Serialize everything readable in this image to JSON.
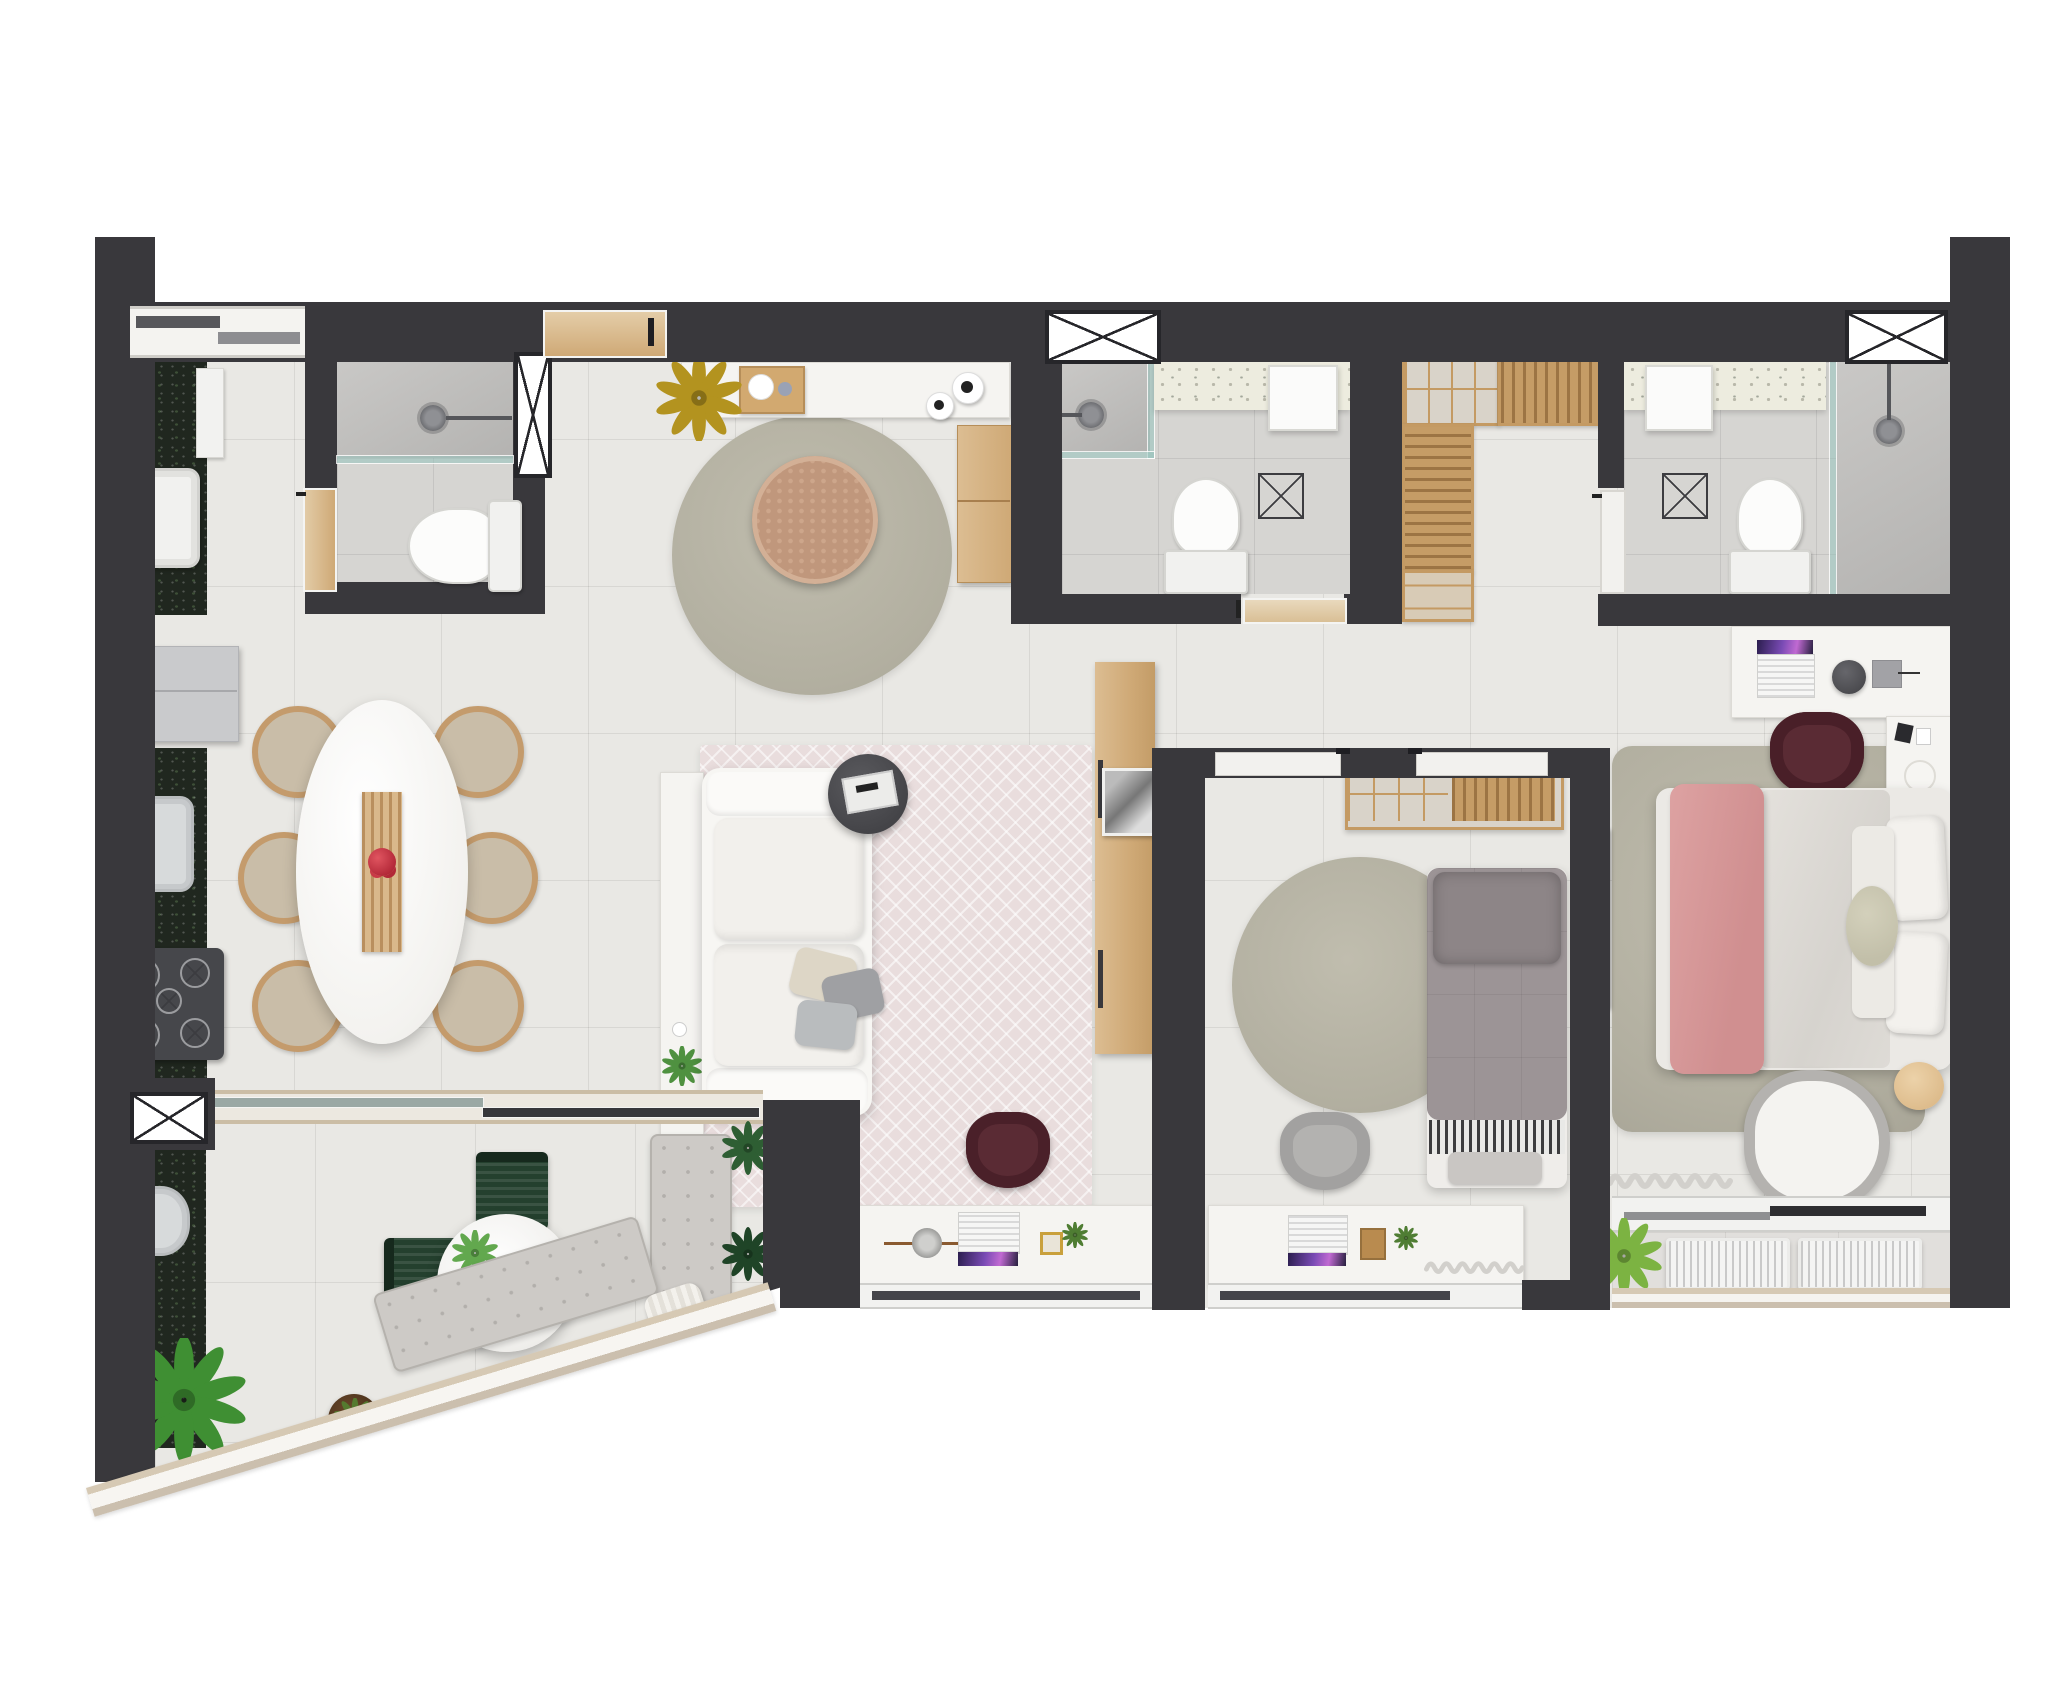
{
  "document": {
    "type": "apartment-floor-plan-rendering",
    "view": "top-down 3D render",
    "visible_text": "none"
  },
  "palette": {
    "wall": "#39383c",
    "floor": "#e9e8e4",
    "bathfloor": "#d6d5d2",
    "granite": "#20271f",
    "terrazzo": "#edecdf",
    "wood": "#d2a970",
    "wood_light": "#dcbd92",
    "rug_sage": "#b5b2a3",
    "rug_pink": "#e9dddd",
    "bed_pink": "#d89798",
    "duvet_gray": "#9c9496",
    "chair_burgundy": "#5a2b34",
    "chair_green": "#24402e",
    "furniture_white": "#f5f4f1"
  },
  "rooms": [
    {
      "name": "service-area",
      "furniture": [
        "granite-counter",
        "laundry-sink",
        "tall-cabinet",
        "sliding-service-door"
      ]
    },
    {
      "name": "service-bathroom",
      "furniture": [
        "shower-head",
        "glass-partition",
        "window",
        "toilet",
        "wooden-door"
      ]
    },
    {
      "name": "entry-hall",
      "furniture": [
        "entry-door",
        "sideboard",
        "wooden-tray-with-cups",
        "two-canisters",
        "yellow-plant",
        "round-rug",
        "rattan-pouf",
        "wooden-bench"
      ]
    },
    {
      "name": "bathroom-2",
      "furniture": [
        "window",
        "corner-shower",
        "glass-partition",
        "terrazzo-counter",
        "sink",
        "toilet",
        "floor-drain",
        "pocket-door"
      ]
    },
    {
      "name": "walk-in-closet",
      "furniture": [
        "cubby-shelf",
        "hanging-rail-shelf",
        "tall-hanging-unit",
        "drawer-unit"
      ]
    },
    {
      "name": "ensuite-bathroom",
      "furniture": [
        "terrazzo-counter",
        "sink",
        "floor-drain",
        "toilet",
        "shower",
        "glass-partition",
        "window",
        "door"
      ]
    },
    {
      "name": "kitchen",
      "furniture": [
        "fridge",
        "granite-counter",
        "steel-sink",
        "five-burner-cooktop"
      ]
    },
    {
      "name": "dining-area",
      "furniture": [
        "oval-marble-table",
        "wood-runner",
        "red-fruit-bowl",
        "dining-chair-1",
        "dining-chair-2",
        "dining-chair-3",
        "dining-chair-4",
        "dining-chair-5",
        "dining-chair-6"
      ]
    },
    {
      "name": "living-room",
      "furniture": [
        "console",
        "console-plant",
        "white-sofa",
        "throw-pillows",
        "round-side-table-with-tray",
        "herringbone-rug",
        "wood-wardrobe-panel",
        "desk-with-laptop",
        "burgundy-desk-chair",
        "window"
      ]
    },
    {
      "name": "bedroom-2",
      "furniture": [
        "wardrobe-cubbies-and-rail",
        "round-rug",
        "single-bed-gray",
        "striped-blanket",
        "desk-with-laptop",
        "gray-chair",
        "curtain",
        "window",
        "sliding-doors"
      ]
    },
    {
      "name": "master-bedroom",
      "furniture": [
        "desk-with-laptop",
        "stool",
        "pen-tray",
        "burgundy-chair",
        "nightstand-with-perfumes",
        "double-bed",
        "pink-runner",
        "pillows",
        "sage-rug",
        "wall-tv",
        "armchair",
        "wood-side-table",
        "curtain",
        "window",
        "balcony-strip",
        "ac-condenser-1",
        "ac-condenser-2",
        "balcony-plant"
      ]
    },
    {
      "name": "balcony",
      "furniture": [
        "sliding-glass-door",
        "granite-counter",
        "round-sink",
        "bistro-table",
        "table-plants",
        "coffee-cup",
        "green-chair-1",
        "green-chair-2",
        "tufted-bench-straight",
        "tufted-bench-angled",
        "knit-pillow",
        "striped-pillow",
        "pink-throw",
        "large-plant",
        "potted-plant",
        "corner-bushes",
        "glass-railing"
      ]
    }
  ],
  "openings": {
    "windows_x_symbol": 5,
    "bottom_window_bands": 3,
    "doors": [
      "service-slider",
      "entry-wood-door",
      "bath1-wood-door",
      "bath2-pocket-door",
      "bath3-door",
      "bedroom2-slider",
      "master-slider",
      "balcony-glass-slider"
    ]
  }
}
